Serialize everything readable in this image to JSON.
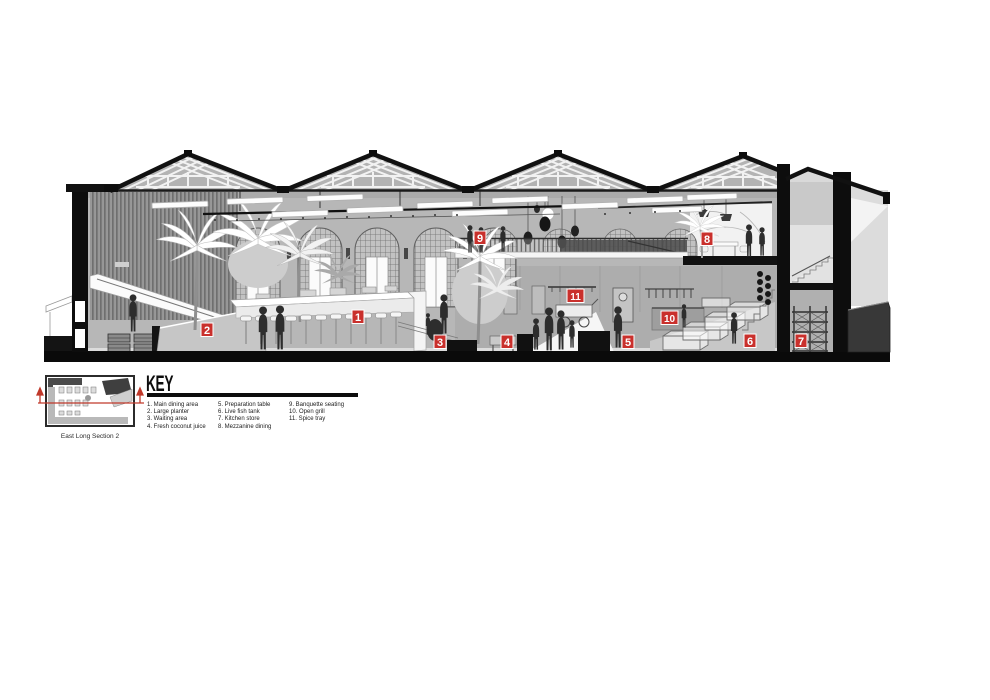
{
  "document": {
    "type": "Architectural long section drawing",
    "background": "#ffffff"
  },
  "section": {
    "name": "East Long Section 2",
    "marker_color": "#c9302c",
    "markers": [
      {
        "num": "1",
        "label": "Main dining area",
        "x": 352,
        "y": 310
      },
      {
        "num": "2",
        "label": "Large planter",
        "x": 201,
        "y": 323
      },
      {
        "num": "3",
        "label": "Waiting area",
        "x": 434,
        "y": 335
      },
      {
        "num": "4",
        "label": "Fresh coconut juice",
        "x": 501,
        "y": 335
      },
      {
        "num": "5",
        "label": "Preparation table",
        "x": 622,
        "y": 335
      },
      {
        "num": "6",
        "label": "Live fish tank",
        "x": 744,
        "y": 334
      },
      {
        "num": "7",
        "label": "Kitchen store",
        "x": 795,
        "y": 334
      },
      {
        "num": "8",
        "label": "Mezzanine dining",
        "x": 701,
        "y": 232
      },
      {
        "num": "9",
        "label": "Banquette seating",
        "x": 474,
        "y": 231
      },
      {
        "num": "10",
        "label": "Open grill",
        "x": 661,
        "y": 311
      },
      {
        "num": "11",
        "label": "Spice tray",
        "x": 567,
        "y": 289
      }
    ]
  },
  "key": {
    "title": "KEY",
    "items": [
      {
        "num": "1",
        "label": "Main dining area"
      },
      {
        "num": "2",
        "label": "Large planter"
      },
      {
        "num": "3",
        "label": "Waiting area"
      },
      {
        "num": "4",
        "label": "Fresh coconut juice"
      },
      {
        "num": "5",
        "label": "Preparation table"
      },
      {
        "num": "6",
        "label": "Live fish tank"
      },
      {
        "num": "7",
        "label": "Kitchen store"
      },
      {
        "num": "8",
        "label": "Mezzanine dining"
      },
      {
        "num": "9",
        "label": "Banquette seating"
      },
      {
        "num": "10",
        "label": "Open grill"
      },
      {
        "num": "11",
        "label": "Spice tray"
      }
    ],
    "columns": [
      4,
      4,
      3
    ]
  },
  "thumbnail": {
    "caption": "East Long Section 2"
  }
}
